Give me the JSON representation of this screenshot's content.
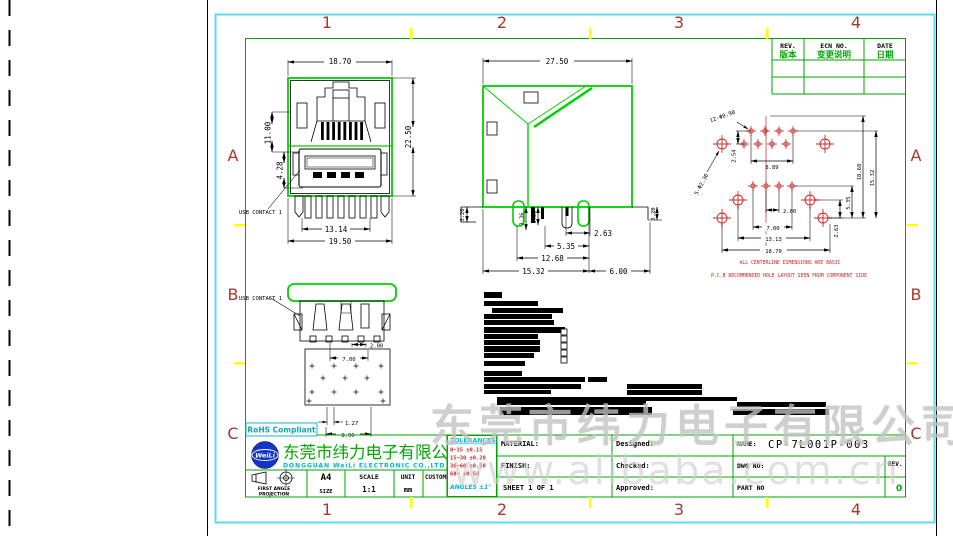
{
  "zones": {
    "cols": [
      "1",
      "2",
      "3",
      "4"
    ],
    "rows": [
      "A",
      "B",
      "C"
    ]
  },
  "rev_table": {
    "col_rev_en": "REV.",
    "col_rev_cn": "版本",
    "col_ecn_en": "ECN NO.",
    "col_ecn_cn": "变更说明",
    "col_date_en": "DATE",
    "col_date_cn": "日期"
  },
  "front_view": {
    "dim_top_width": "18.70",
    "dim_total_height": "22.50",
    "dim_rj45_center": "11.00",
    "dim_usb_center": "4.28",
    "dim_leg_span": "13.14",
    "dim_base_width": "19.50",
    "usb_contact_label": "USB CONTACT 1"
  },
  "side_view": {
    "dim_depth": "27.50",
    "dim_pin_a": "3.36",
    "dim_pin_b": "3.20",
    "dim_left_tail": "3.20",
    "dim_right_tail": "3.20",
    "dim_rear": "2.63",
    "dim_post_front": "5.35",
    "dim_post_span": "12.68",
    "dim_pin_span": "15.32",
    "dim_front": "6.00"
  },
  "pcb_view": {
    "callout_small_holes": "12-Φ0.90",
    "callout_big_holes": "5-Φ2.30",
    "dim_row_pitch": "2.54",
    "dim_row_width": "8.89",
    "dim_usb_pitch": "2.00",
    "dim_usb_span": "7.00",
    "dim_post_width": "13.13",
    "dim_total_width": "18.70",
    "dim_v_rear": "2.63",
    "dim_v_post": "5.35",
    "dim_v_inner": "18.68",
    "dim_v_outer": "15.32",
    "note_line1": "ALL CENTERLINE DIMENSIONS ARE BASIC",
    "note_line2": "P.C.B RECOMMENDED HOLE LAYOUT SEEN FROM COMPONENT SIDE"
  },
  "rear_view": {
    "dim_contact_pitch": "2.00",
    "dim_contact_span": "7.00",
    "dim_hole_pitch": "1.27",
    "dim_hole_span": "8.90",
    "usb_contact_label": "USB CONTACT 1"
  },
  "title_block": {
    "rohs_badge": "RoHS Compliant",
    "logo_text": "WeiLi",
    "company_cn": "东莞市纬力电子有限公司",
    "company_en": "DONGGUAN WeiLi ELECTRONIC CO.,LTD",
    "projection_line1": "FIRST ANGLE",
    "projection_line2": "PROJECTION",
    "size_value": "A4",
    "size_label": "SIZE",
    "scale_label": "SCALE",
    "scale_value": "1:1",
    "unit_label": "UNIT",
    "unit_value": "mm",
    "customer_label": "CUSTOMER:",
    "tolerances_title": "TOLERANCES:",
    "tolerance_rows": [
      "0~15   ±0.15",
      "15~30  ±0.20",
      "30~60  ±0.30",
      "60~    ±0.50"
    ],
    "tolerance_angles": "ANGLES ±1°",
    "material_label": "MATERIAL:",
    "finish_label": "FINISH:",
    "sheet_label": "SHEET 1  OF  1",
    "designed_label": "Designed:",
    "checked_label": "Checked:",
    "approved_label": "Approved:",
    "name_label": "NAME:",
    "name_value": "CP-7L001P-003",
    "dwg_label": "DWG NO:",
    "rev_label": "REV.",
    "part_label": "PART NO",
    "rev_value": "0"
  },
  "watermarks": {
    "center": "东莞市纬力电子有限公司",
    "bottom": "www.alibaba.com.cn"
  },
  "colors": {
    "page_border_cyan": "#5adcec",
    "frame_green": "#00a400",
    "part_green": "#00d000",
    "zone_label_red": "#a8372c",
    "pcb_red": "#cc2222",
    "tolerance_red": "#cc2222",
    "cyan_text": "#00b8cc",
    "company_green": "#00a800",
    "logo_blue": "#1433cc",
    "zone_tick_yellow": "#ffff00"
  }
}
